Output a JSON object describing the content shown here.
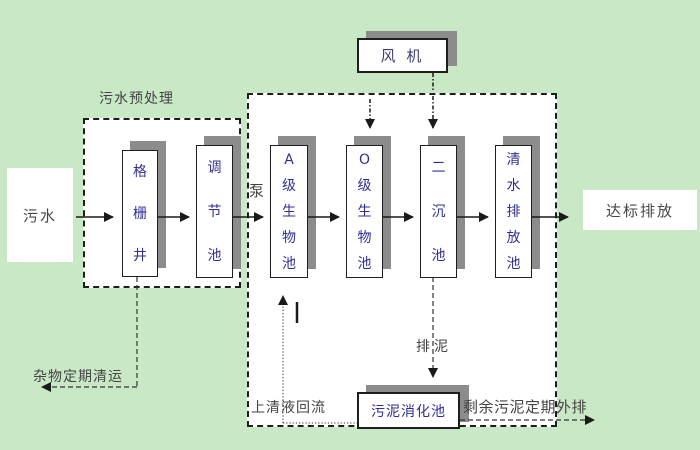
{
  "colors": {
    "background": "#c9e8c5",
    "region_fill": "#ffffff",
    "box_shadow": "#8c8c8c",
    "tank_text": "#2f2f9a",
    "label_text": "#444444",
    "line": "#1a1a1a"
  },
  "nodes": {
    "sewage": "污水",
    "grid_well": "格栅井",
    "regulating_tank": "调节池",
    "pump": "泵",
    "a_bio_tank": "A级生物池",
    "o_bio_tank": "O级生物池",
    "secondary_sed_tank": "二沉池",
    "clear_water_tank": "清水排放池",
    "blower": "风 机",
    "sludge_digestion_tank": "污泥消化池",
    "discharge": "达标排放"
  },
  "labels": {
    "pretreatment_zone": "污水预处理",
    "debris_removal": "杂物定期清运",
    "supernatant_return": "上清液回流",
    "sludge_discharge": "排泥",
    "excess_sludge_out": "剩余污泥定期外排"
  }
}
